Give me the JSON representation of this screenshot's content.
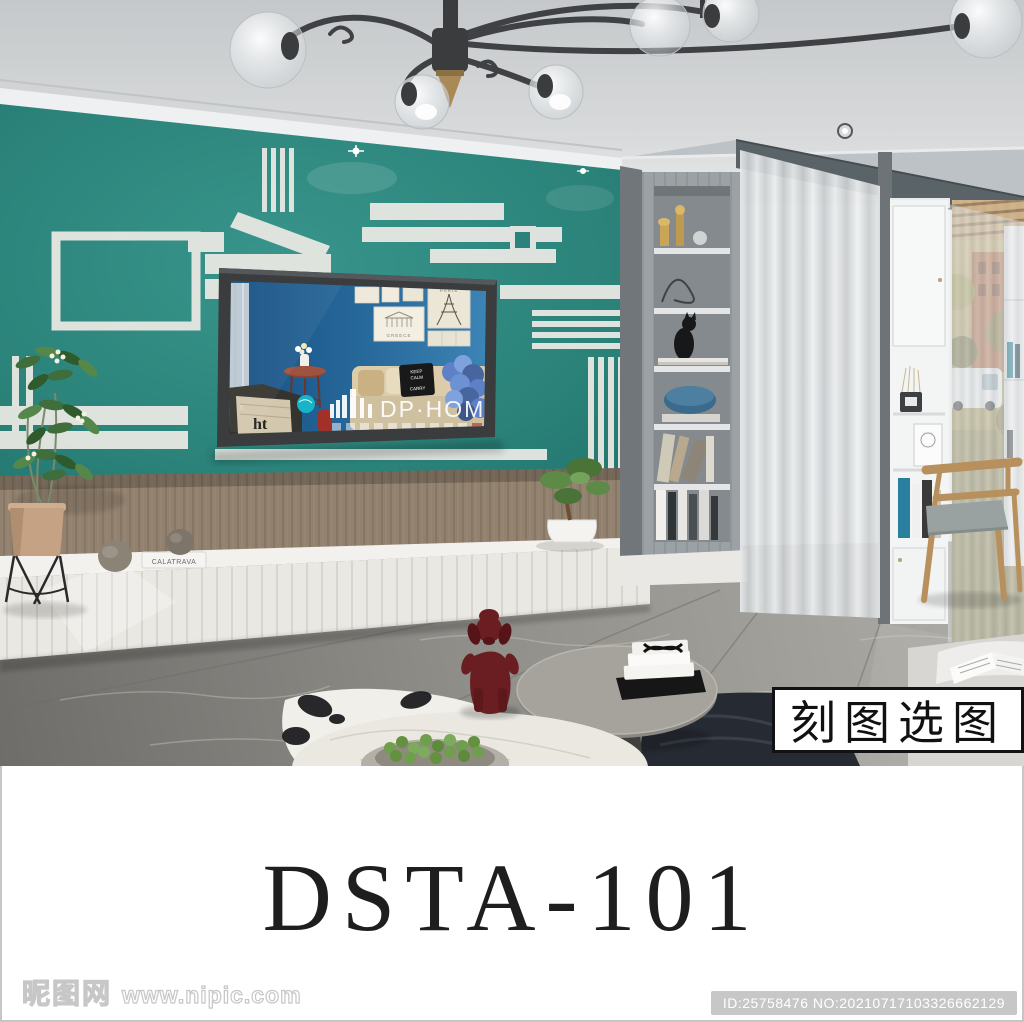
{
  "page": {
    "product_code": "DSTA-101",
    "selection_label": "刻图选图",
    "watermark": {
      "site_name": "昵图网",
      "site_url": "www.nipic.com",
      "image_id": "ID:25758476 NO:20210717103326662129"
    }
  },
  "scene": {
    "description": "living room render with teal geometric TV feature wall",
    "tv_screen": {
      "brand_watermark": "DP·HOME",
      "frame_paris_label": "PARIS",
      "frame_greece_label": "GREECE",
      "pillow_lines": [
        "KEEP",
        "CALM",
        "CARRY"
      ],
      "blanket_letters": "ht",
      "blanket_small": "r."
    },
    "bench": {
      "book_spine": "CALATRAVA"
    },
    "colors": {
      "accent_wall_teal": "#2b837a",
      "wall_pattern_white": "#e6e7e2",
      "tv_screen_wall_blue": "#2a6d9e",
      "floor_marble_gray": "#8e8d88",
      "poodle_red": "#6b1e21",
      "beam_gray": "#5a6367"
    }
  }
}
